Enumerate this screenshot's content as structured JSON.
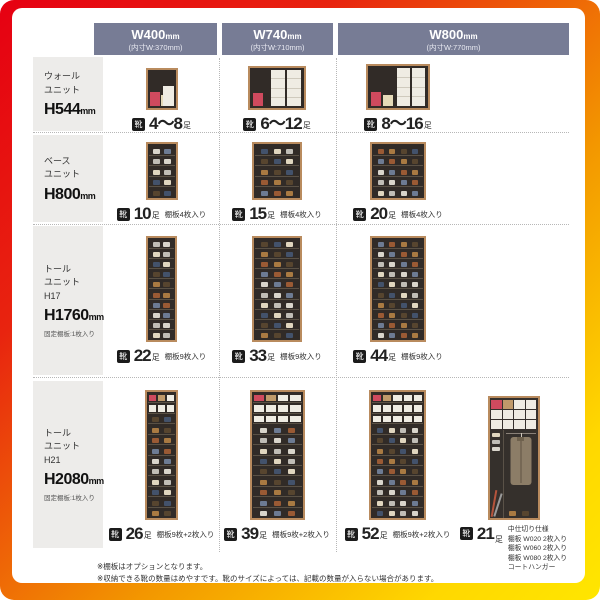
{
  "header": {
    "columns": [
      {
        "size": "W400",
        "unit": "mm",
        "inner": "(内寸W:370mm)"
      },
      {
        "size": "W740",
        "unit": "mm",
        "inner": "(内寸W:710mm)"
      },
      {
        "size": "W800",
        "unit": "mm",
        "inner": "(内寸W:770mm)"
      }
    ]
  },
  "row_labels": [
    {
      "lines": [
        "ウォール",
        "ユニット"
      ],
      "height": "H544",
      "height_unit": "mm",
      "note": ""
    },
    {
      "lines": [
        "ベース",
        "ユニット"
      ],
      "height": "H800",
      "height_unit": "mm",
      "note": ""
    },
    {
      "lines": [
        "トール",
        "ユニット",
        "H17"
      ],
      "height": "H1760",
      "height_unit": "mm",
      "note": "固定棚板:1枚入り"
    },
    {
      "lines": [
        "トール",
        "ユニット",
        "H21"
      ],
      "height": "H2080",
      "height_unit": "mm",
      "note": "固定棚板:1枚入り"
    }
  ],
  "shoe_icon": "靴",
  "capacity_unit": "足",
  "cells": [
    [
      {
        "count": "4〜8",
        "note": ""
      },
      {
        "count": "6〜12",
        "note": ""
      },
      {
        "count": "8〜16",
        "note": ""
      }
    ],
    [
      {
        "count": "10",
        "note": "棚板4枚入り"
      },
      {
        "count": "15",
        "note": "棚板4枚入り"
      },
      {
        "count": "20",
        "note": "棚板4枚入り"
      }
    ],
    [
      {
        "count": "22",
        "note": "棚板9枚入り"
      },
      {
        "count": "33",
        "note": "棚板9枚入り"
      },
      {
        "count": "44",
        "note": "棚板9枚入り"
      }
    ],
    [
      {
        "count": "26",
        "note": "棚板9枚+2枚入り"
      },
      {
        "count": "39",
        "note": "棚板9枚+2枚入り"
      },
      {
        "count": "52",
        "note": "棚板9枚+2枚入り"
      },
      {
        "count": "21",
        "note_lines": [
          "中仕切り仕様",
          "棚板 W020 2枚入り",
          "棚板 W060 2枚入り",
          "棚板 W080 2枚入り",
          "コートハンガー"
        ]
      }
    ]
  ],
  "footnotes": [
    "※棚板はオプションとなります。",
    "※収納できる靴の数量はめやすです。靴のサイズによっては、記載の数量が入らない場合があります。"
  ],
  "colors": {
    "frame_gradient": [
      "#e60012",
      "#f39800",
      "#ffe600"
    ],
    "header_bg": "#777c95",
    "label_bg": "#edecea",
    "cabinet_frame": "#b98b5e",
    "cabinet_interior": "#312b27",
    "accent_box_pink": "#cf4a5e",
    "box_white": "#efece3"
  }
}
